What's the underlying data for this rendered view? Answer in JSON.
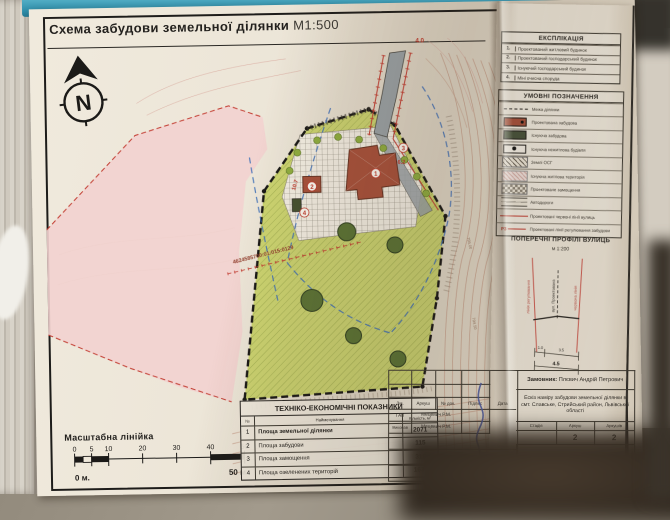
{
  "sheet": {
    "title": "Схема забудови земельної ділянки",
    "title_scale": "М1:500",
    "north_label": "N"
  },
  "map": {
    "cadastral_number": "4624585700:01:015:0129",
    "labels": {
      "dim_road_width": "4.0",
      "dim_house_offset": "10.7",
      "dim_side_offset": "6.2",
      "marker_1": "1",
      "marker_2": "2",
      "marker_3": "3",
      "marker_4": "4",
      "elevation_1": "795.00",
      "elevation_2": "794.50"
    }
  },
  "explication": {
    "title": "ЕКСПЛІКАЦІЯ",
    "rows": [
      {
        "num": "1.",
        "label": "Проектований житловий будинок"
      },
      {
        "num": "2.",
        "label": "Проектований господарський будинок"
      },
      {
        "num": "3.",
        "label": "Існуючий господарський будинок"
      },
      {
        "num": "4.",
        "label": "Міні очисна споруда"
      }
    ]
  },
  "legend": {
    "title": "УМОВНІ ПОЗНАЧЕННЯ",
    "rows": [
      {
        "label": "Межа ділянки"
      },
      {
        "label": "Проектована забудова"
      },
      {
        "label": "Існуюча забудова"
      },
      {
        "label": "Існуюча нежитлова будівля"
      },
      {
        "label": "Землі ОСГ"
      },
      {
        "label": "Існуюча житлова територія"
      },
      {
        "label": "Проектоване замощення"
      },
      {
        "label": "Автодороги"
      },
      {
        "label": "Проектовані червоні лінії вулиць"
      },
      {
        "label": "Проектовані лінії регулювання забудови",
        "mark": "Р3"
      }
    ]
  },
  "profiles": {
    "title": "ПОПЕРЕЧНІ ПРОФІЛІ ВУЛИЦЬ",
    "scale": "м 1:200",
    "left_line_label": "лінія регулювання",
    "center_label": "вул. Проектована",
    "right_line_label": "червона лінія",
    "dim_left": "1.0",
    "dim_right": "3.5",
    "dim_total": "4.5"
  },
  "scale_bar": {
    "title": "Масштабна лінійка",
    "ticks": [
      "0",
      "5",
      "10",
      "20",
      "30",
      "40",
      "50"
    ],
    "start_label": "0 м.",
    "end_label": "50 м."
  },
  "tech_table": {
    "title": "ТЕХНІКО-ЕКОНОМІЧНІ ПОКАЗНИКИ",
    "col_num": "№",
    "col_name": "Найменування",
    "col_qty": "Кількість, м²",
    "rows": [
      {
        "num": "1",
        "name": "Площа земельної ділянки",
        "value": "2071"
      },
      {
        "num": "2",
        "name": "Площа забудови",
        "value": "115"
      },
      {
        "num": "3",
        "name": "Площа замощення",
        "value": "318"
      },
      {
        "num": "4",
        "name": "Площа озеленених територій",
        "value": "1638"
      }
    ]
  },
  "stamp": {
    "cols": [
      "Зм.",
      "Аркуш",
      "№ док.",
      "Підпис",
      "Дата"
    ],
    "row_gap_role": "ГАП",
    "row_gap_name": "Мецевич Р.М.",
    "row_exec_role": "Виконав",
    "row_exec_name": "Мецевич Р.М.",
    "client_label": "Замовник:",
    "client_name": "Плєвич Андрій Петрович",
    "project": "Ескіз наміру забудови земельної ділянки в смт. Славське, Стрийський район, Львівської області",
    "stage_col": "Стадія",
    "sheet_col": "Аркуш",
    "sheets_col": "Аркушів",
    "sheet_num": "2",
    "sheets_total": "2",
    "doc_name": "Схема забудови земельної ділянки М 1:500",
    "company": "ФОП \"Мецевич Р.М.\""
  }
}
